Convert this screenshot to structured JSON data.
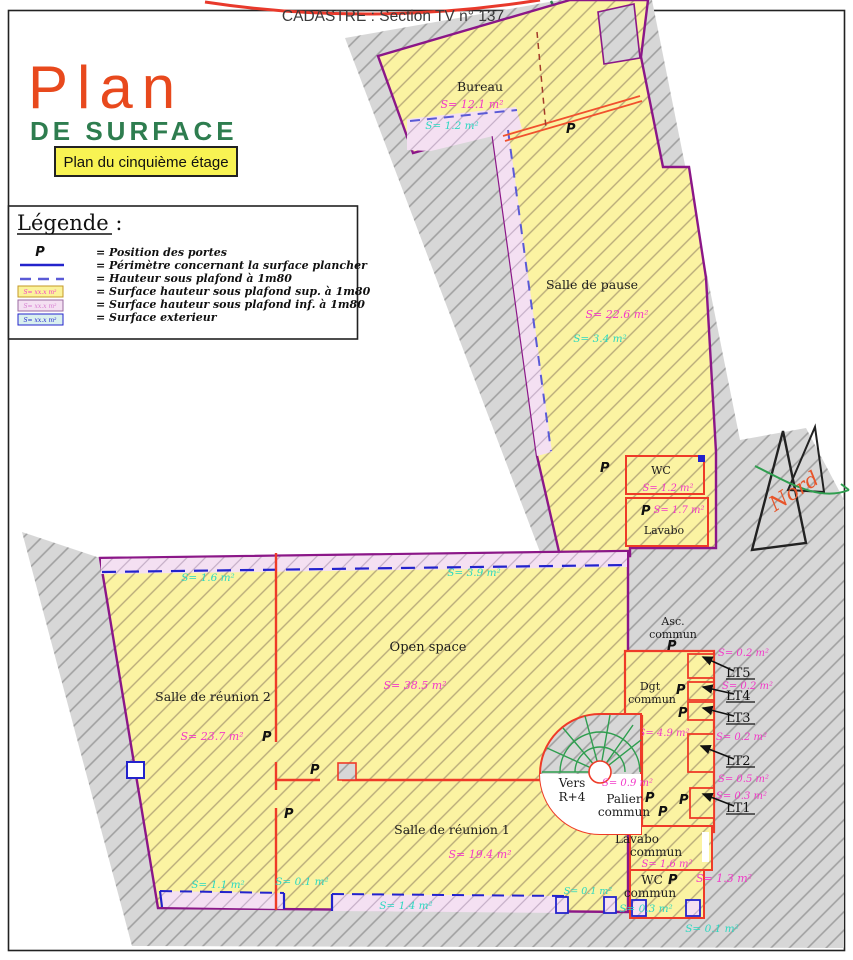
{
  "header": {
    "cadastre": "CADASTRE : Section TV n° 137",
    "title_word1": "Plan",
    "title_word2": "DE SURFACE",
    "floor_badge": "Plan du cinquième étage"
  },
  "legend": {
    "title": "Légende :",
    "door_symbol": "P",
    "swatch_text": "S= xx.x m²",
    "items": [
      "= Position des portes",
      "= Périmètre concernant la surface plancher",
      "= Hauteur sous plafond à 1m80",
      "= Surface hauteur sous plafond sup. à 1m80",
      "= Surface hauteur sous plafond inf. à 1m80",
      "= Surface exterieur"
    ]
  },
  "compass": {
    "label": "Nord"
  },
  "door_label": "P",
  "rooms": {
    "bureau": {
      "name": "Bureau",
      "surface": "S= 12.1 m²",
      "surface_ext": "S= 1.2 m²"
    },
    "salle_de_pause": {
      "name": "Salle de pause",
      "surface": "S= 22.6 m²",
      "surface_ext": "S= 3.4 m²"
    },
    "wc": {
      "name": "WC",
      "surface": "S= 1.2 m²"
    },
    "lavabo": {
      "name": "Lavabo",
      "surface": "S= 1.7 m²"
    },
    "salle_reunion_2": {
      "name": "Salle de réunion 2",
      "surface": "S= 23.7 m²",
      "surface_ext_top": "S= 1.6 m²",
      "surface_ext_bottom": "S= 1.1 m²"
    },
    "open_space": {
      "name": "Open space",
      "surface": "S= 38.5 m²",
      "surface_ext_top": "S= 3.9 m²",
      "surface_ext_bottom": "S= 0.1 m²"
    },
    "salle_reunion_1": {
      "name": "Salle de réunion 1",
      "surface": "S= 19.4 m²",
      "surface_ext_bottom": "S= 1.4 m²",
      "surface_ext_right": "S= 0.1 m²"
    },
    "asc_commun": {
      "name_line1": "Asc.",
      "name_line2": "commun"
    },
    "dgt_commun": {
      "name_line1": "Dgt",
      "name_line2": "commun",
      "surface": "S= 4.9 m²"
    },
    "palier_commun": {
      "name_line1": "Palier",
      "name_line2": "commun",
      "surface": "S= 0.9 m²"
    },
    "stairs": {
      "line1": "Vers",
      "line2": "R+4"
    },
    "lavabo_commun": {
      "name_line1": "Lavabo",
      "name_line2": "commun",
      "surface": "S= 1.6 m²"
    },
    "wc_commun": {
      "name_line1": "WC",
      "name_line2": "commun",
      "surface": "S= 1.3 m²",
      "surface_ext": "S= 0.3 m²",
      "surface_ext_outside": "S= 0.1 m²"
    },
    "lt_rooms": {
      "labels": [
        "LT5",
        "LT4",
        "LT3",
        "LT2",
        "LT1"
      ],
      "surfaces": [
        "S= 0.2 m²",
        "S= 0.2 m²",
        "S= 0.2 m²",
        "S= 0.5 m²",
        "S= 0.3 m²"
      ]
    }
  },
  "colors": {
    "wall_exterior": "#8b1788",
    "wall_interior": "#ee3b28",
    "surface_interior_text": "#f23ac8",
    "surface_exterior_text": "#2cd8c1",
    "perimeter_blue": "#2323cc",
    "stair_green": "#2f9e4f",
    "title_orange": "#e8491d",
    "title_green": "#2e7d4f"
  }
}
